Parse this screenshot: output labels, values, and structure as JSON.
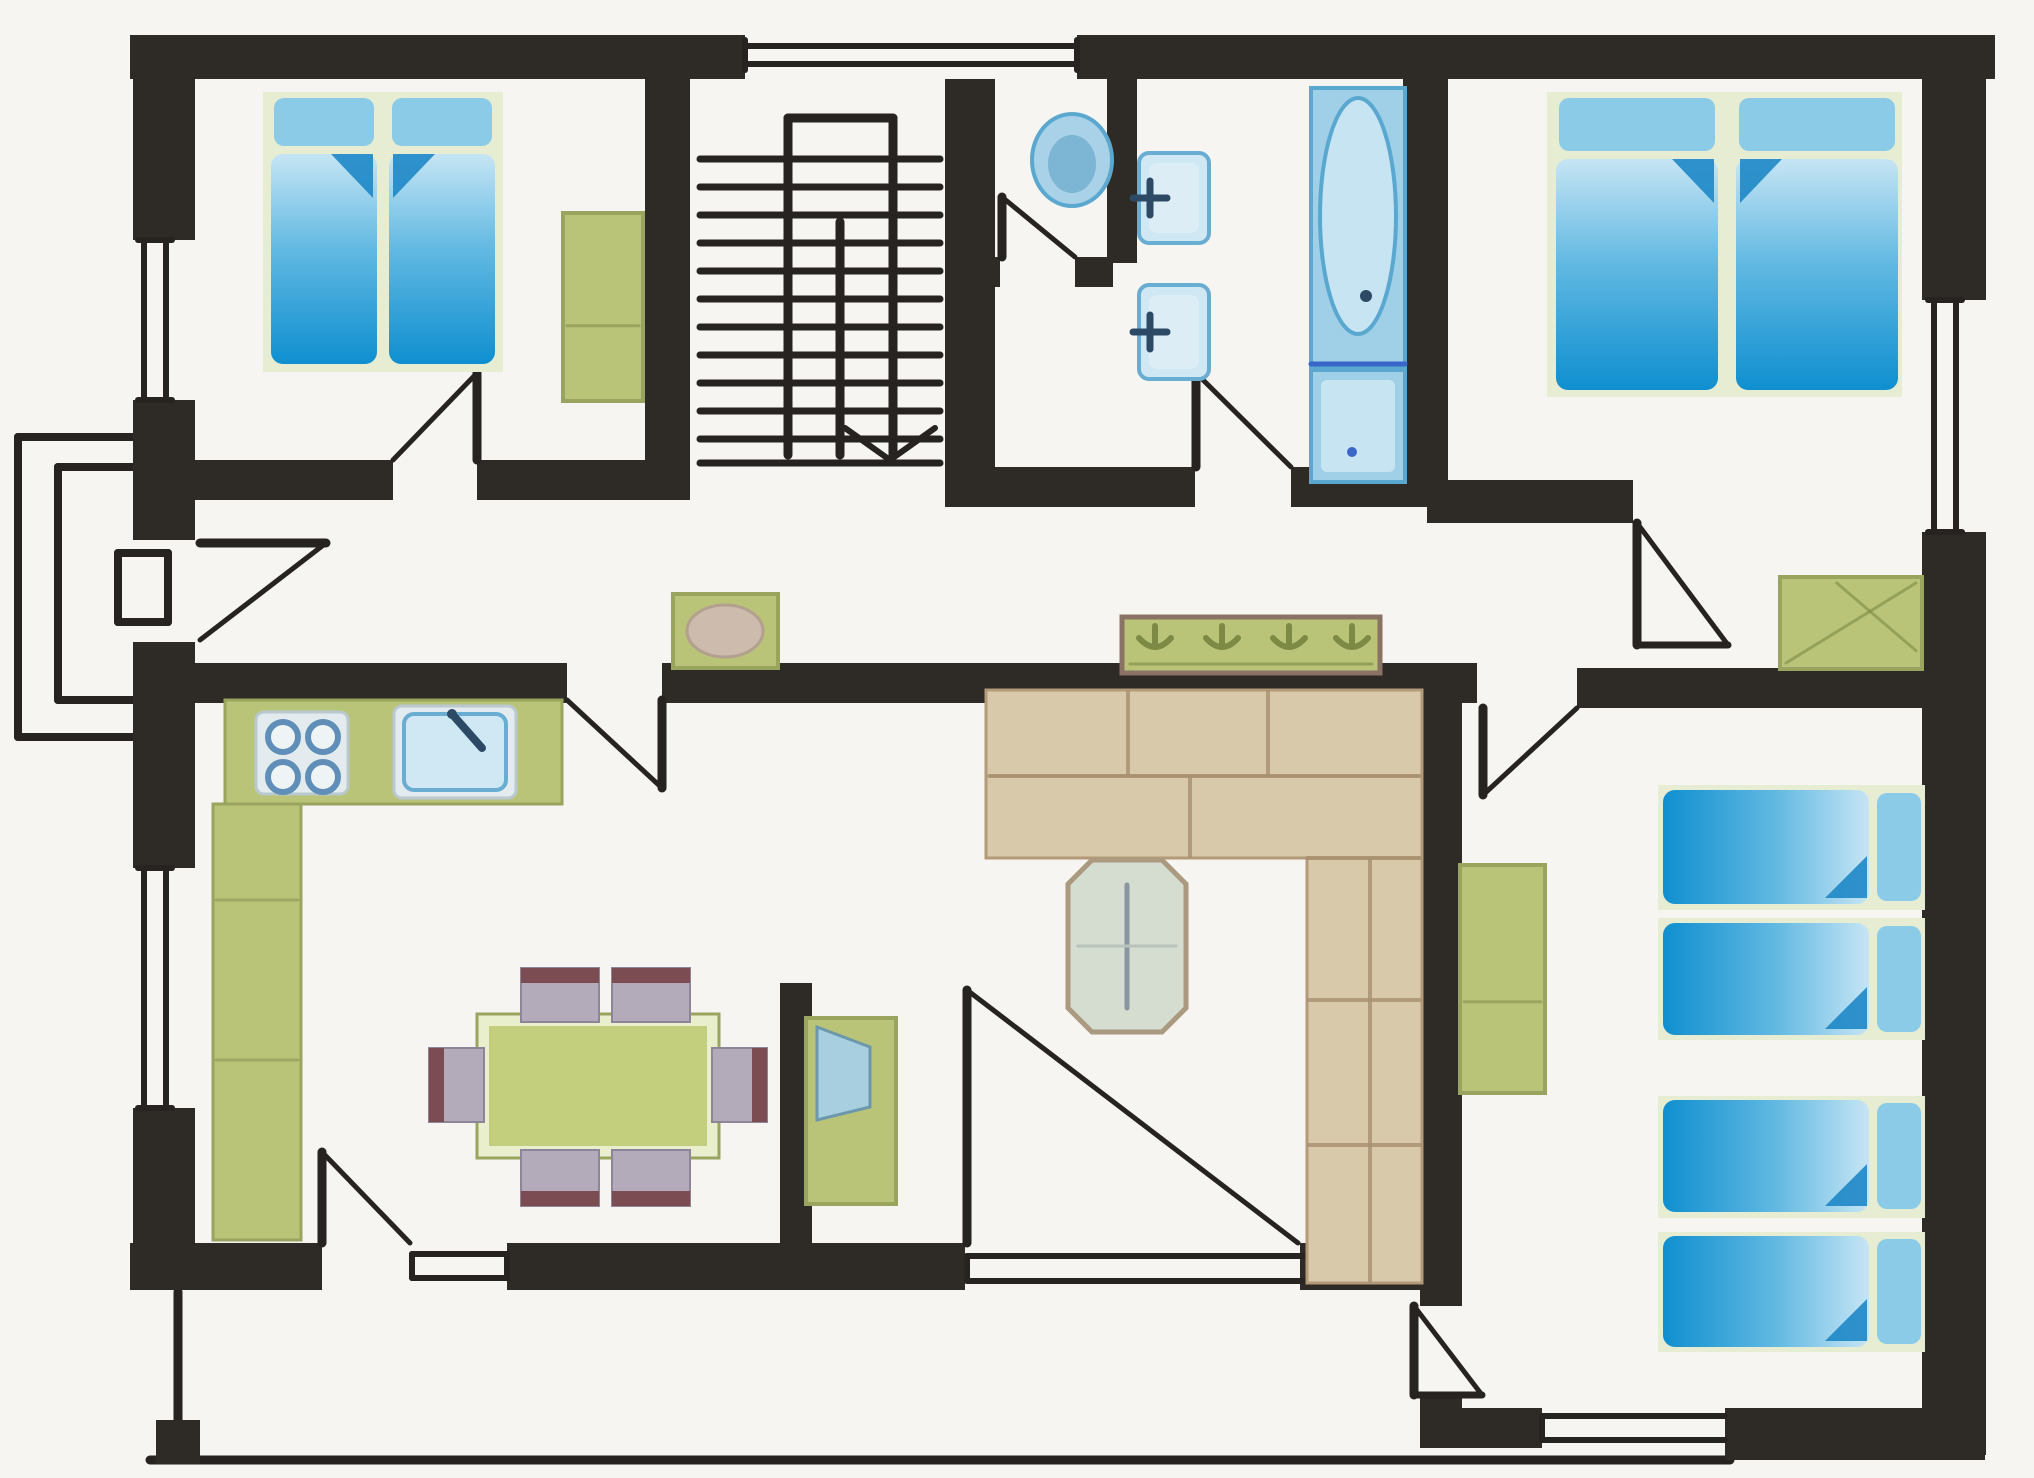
{
  "canvas": {
    "width": 2034,
    "height": 1478
  },
  "palette": {
    "paper": "#f7f5f2",
    "wall": "#2e2a26",
    "line": "#262320",
    "bed_deep": "#0f8fd0",
    "bed_mid": "#62b9e2",
    "bed_light": "#c6e5f4",
    "pillow": "#8ccbe8",
    "mat": "#e7edd2",
    "fold": "#1583c4",
    "green": "#b9c478",
    "green_dark": "#99a45e",
    "green_deep": "#7d8a45",
    "plate": "#e3ebee",
    "burner": "#5f8fb8",
    "basin_fill": "#cfe8f3",
    "basin_edge": "#69aed2",
    "fixture": "#9fd0e8",
    "fixture_deep": "#5aa8cf",
    "fixture_pale": "#c6e4f2",
    "ink_blue": "#2c4a66",
    "tub_line": "#3b66c9",
    "sofa": "#d9c9ab",
    "sofa_edge": "#b49a78",
    "sofa_seam": "#a8906f",
    "seat": "#b3aaba",
    "chair_back": "#7b4d52",
    "table_rim": "#e9eecd",
    "table_top": "#c3cf7d",
    "oct_fill": "#d4ddd0",
    "oct_edge": "#ab9980",
    "oct_line": "#8796a0",
    "rack_edge": "#8a7265",
    "oval_tan": "#cdbcad",
    "screen": "#a8cfe0",
    "screen_edge": "#6d98ac"
  },
  "rooms": [
    {
      "name": "room-bedroom-1",
      "r": [
        195,
        79,
        450,
        381
      ]
    },
    {
      "name": "room-stair-hall",
      "r": [
        690,
        79,
        255,
        426
      ]
    },
    {
      "name": "room-wc",
      "r": [
        995,
        79,
        112,
        178
      ]
    },
    {
      "name": "room-bathroom",
      "r": [
        1137,
        79,
        266,
        388
      ]
    },
    {
      "name": "room-bedroom-2",
      "r": [
        1448,
        79,
        474,
        401
      ]
    },
    {
      "name": "room-hallway",
      "r": [
        195,
        500,
        1727,
        163
      ]
    },
    {
      "name": "room-kitchen-dining",
      "r": [
        195,
        703,
        585,
        540
      ]
    },
    {
      "name": "room-living-room",
      "r": [
        812,
        703,
        608,
        540
      ]
    },
    {
      "name": "room-bedroom-3",
      "r": [
        1462,
        708,
        460,
        700
      ]
    },
    {
      "name": "room-terrace",
      "r": [
        195,
        1290,
        1225,
        168
      ]
    },
    {
      "name": "room-porch",
      "r": [
        18,
        437,
        159,
        300
      ]
    }
  ],
  "walls": [
    [
      130,
      35,
      615,
      44
    ],
    [
      1077,
      35,
      918,
      44
    ],
    [
      133,
      35,
      62,
      205
    ],
    [
      133,
      400,
      62,
      140
    ],
    [
      133,
      642,
      62,
      226
    ],
    [
      133,
      1108,
      62,
      182
    ],
    [
      1922,
      35,
      64,
      265
    ],
    [
      1922,
      532,
      64,
      923
    ],
    [
      130,
      1243,
      192,
      47
    ],
    [
      507,
      1243,
      458,
      47
    ],
    [
      1298,
      1243,
      164,
      47
    ],
    [
      1420,
      1408,
      122,
      40
    ],
    [
      1725,
      1408,
      260,
      52
    ],
    [
      645,
      35,
      45,
      465
    ],
    [
      133,
      460,
      260,
      40
    ],
    [
      477,
      460,
      213,
      40
    ],
    [
      945,
      35,
      50,
      472
    ],
    [
      1107,
      35,
      30,
      228
    ],
    [
      960,
      257,
      40,
      30
    ],
    [
      1075,
      257,
      38,
      30
    ],
    [
      945,
      467,
      250,
      40
    ],
    [
      1291,
      467,
      136,
      40
    ],
    [
      1403,
      35,
      45,
      472
    ],
    [
      1427,
      480,
      206,
      43
    ],
    [
      133,
      663,
      434,
      40
    ],
    [
      662,
      663,
      815,
      40
    ],
    [
      1577,
      668,
      345,
      40
    ],
    [
      1420,
      700,
      42,
      606
    ],
    [
      1420,
      1395,
      42,
      50
    ],
    [
      780,
      983,
      32,
      262
    ],
    [
      156,
      1420,
      44,
      44
    ]
  ],
  "windows": [
    {
      "name": "window-stair-top",
      "rect": [
        745,
        35,
        332,
        44
      ],
      "lines": [
        [
          745,
          46,
          1077,
          46
        ],
        [
          745,
          64,
          1077,
          64
        ],
        [
          745,
          40,
          745,
          70
        ],
        [
          1077,
          40,
          1077,
          70
        ]
      ]
    },
    {
      "name": "window-bedroom1-left",
      "rect": [
        133,
        240,
        62,
        160
      ],
      "lines": [
        [
          144,
          240,
          144,
          400
        ],
        [
          166,
          240,
          166,
          400
        ],
        [
          138,
          240,
          172,
          240
        ],
        [
          138,
          400,
          172,
          400
        ]
      ]
    },
    {
      "name": "window-kitchen-left",
      "rect": [
        133,
        868,
        62,
        240
      ],
      "lines": [
        [
          144,
          868,
          144,
          1108
        ],
        [
          166,
          868,
          166,
          1108
        ],
        [
          138,
          868,
          172,
          868
        ],
        [
          138,
          1108,
          172,
          1108
        ]
      ]
    },
    {
      "name": "window-bedroom2-right",
      "rect": [
        1922,
        300,
        64,
        232
      ],
      "lines": [
        [
          1934,
          300,
          1934,
          532
        ],
        [
          1956,
          300,
          1956,
          532
        ],
        [
          1928,
          300,
          1962,
          300
        ],
        [
          1928,
          532,
          1962,
          532
        ]
      ]
    },
    {
      "name": "window-kitchen-bottom",
      "rect": [
        412,
        1243,
        95,
        47
      ],
      "lines": [
        [
          412,
          1254,
          507,
          1254
        ],
        [
          412,
          1278,
          507,
          1278
        ],
        [
          412,
          1254,
          412,
          1278
        ],
        [
          507,
          1254,
          507,
          1278
        ]
      ]
    },
    {
      "name": "window-patio-bottom",
      "rect": [
        965,
        1243,
        335,
        47
      ],
      "lines": [
        [
          967,
          1256,
          1320,
          1256
        ],
        [
          967,
          1281,
          1320,
          1281
        ],
        [
          967,
          1256,
          967,
          1281
        ]
      ]
    },
    {
      "name": "window-bedroom3-bottom",
      "rect": [
        1542,
        1408,
        183,
        40
      ],
      "lines": [
        [
          1542,
          1416,
          1725,
          1416
        ],
        [
          1542,
          1440,
          1725,
          1440
        ],
        [
          1542,
          1416,
          1542,
          1440
        ]
      ]
    }
  ],
  "doors": [
    {
      "name": "door-bedroom-1",
      "leaf": [
        477,
        373,
        477,
        460
      ],
      "swing": [
        477,
        373,
        393,
        460
      ]
    },
    {
      "name": "door-wc",
      "leaf": [
        1002,
        197,
        1002,
        257
      ],
      "swing": [
        1002,
        197,
        1075,
        257
      ]
    },
    {
      "name": "door-bathroom",
      "leaf": [
        1196,
        373,
        1196,
        467
      ],
      "swing": [
        1196,
        373,
        1291,
        467
      ]
    },
    {
      "name": "door-bedroom-2",
      "leaf": [
        1637,
        523,
        1637,
        645
      ],
      "swing": [
        1637,
        523,
        1728,
        645
      ],
      "base": [
        1637,
        645,
        1728,
        645
      ]
    },
    {
      "name": "door-entrance",
      "leaf": [
        200,
        543,
        326,
        543
      ],
      "swing": [
        326,
        543,
        200,
        640
      ]
    },
    {
      "name": "door-kitchen",
      "leaf": [
        662,
        700,
        662,
        788
      ],
      "swing": [
        567,
        700,
        662,
        788
      ]
    },
    {
      "name": "door-bedroom-3-hall",
      "leaf": [
        1483,
        708,
        1483,
        795
      ],
      "swing": [
        1577,
        708,
        1483,
        795
      ]
    },
    {
      "name": "door-patio",
      "leaf": [
        967,
        990,
        967,
        1243
      ],
      "swing": [
        967,
        990,
        1298,
        1243
      ]
    },
    {
      "name": "door-kitchen-back",
      "leaf": [
        322,
        1152,
        322,
        1243
      ],
      "swing": [
        322,
        1152,
        410,
        1243
      ]
    },
    {
      "name": "door-bedroom-3-terrace",
      "leaf": [
        1414,
        1306,
        1414,
        1395
      ],
      "swing": [
        1414,
        1306,
        1482,
        1395
      ],
      "base": [
        1414,
        1395,
        1482,
        1395
      ]
    }
  ],
  "stairs": {
    "x1": 700,
    "x2": 940,
    "tread_ys": [
      159,
      187,
      215,
      243,
      271,
      299,
      327,
      355,
      383,
      411,
      439,
      463
    ],
    "rails": [
      [
        788,
        118,
        893,
        118
      ],
      [
        788,
        118,
        788,
        455
      ],
      [
        893,
        118,
        893,
        455
      ],
      [
        840,
        222,
        840,
        455
      ]
    ],
    "arrow": [
      [
        845,
        428,
        890,
        460
      ],
      [
        935,
        428,
        890,
        460
      ]
    ]
  },
  "porch": {
    "lines": [
      [
        18,
        437,
        177,
        437
      ],
      [
        18,
        437,
        18,
        737
      ],
      [
        18,
        737,
        177,
        737
      ],
      [
        58,
        467,
        177,
        467
      ],
      [
        58,
        467,
        58,
        700
      ],
      [
        58,
        700,
        177,
        700
      ],
      [
        118,
        553,
        168,
        553
      ],
      [
        168,
        553,
        168,
        622
      ],
      [
        118,
        622,
        168,
        622
      ],
      [
        118,
        553,
        118,
        622
      ]
    ]
  },
  "terrace": {
    "lines": [
      [
        150,
        1460,
        1730,
        1460
      ],
      [
        178,
        1292,
        178,
        1456
      ]
    ]
  },
  "furniture": {
    "mats": [
      [
        263,
        92,
        240,
        280
      ],
      [
        1547,
        92,
        355,
        305
      ],
      [
        1658,
        785,
        267,
        125
      ],
      [
        1658,
        918,
        267,
        122
      ],
      [
        1658,
        1096,
        267,
        122
      ],
      [
        1658,
        1232,
        267,
        120
      ]
    ],
    "mattresses": [
      {
        "name": "bed-bedroom1-left",
        "r": [
          271,
          98,
          106,
          266
        ],
        "dir": "up",
        "fold": "r"
      },
      {
        "name": "bed-bedroom1-right",
        "r": [
          389,
          98,
          106,
          266
        ],
        "dir": "up",
        "fold": "l"
      },
      {
        "name": "bed-bedroom2-left",
        "r": [
          1556,
          98,
          162,
          292
        ],
        "dir": "up",
        "fold": "r"
      },
      {
        "name": "bed-bedroom2-right",
        "r": [
          1736,
          98,
          162,
          292
        ],
        "dir": "up",
        "fold": "l"
      },
      {
        "name": "bed-bedroom3-1",
        "r": [
          1663,
          790,
          258,
          114
        ],
        "dir": "right"
      },
      {
        "name": "bed-bedroom3-2",
        "r": [
          1663,
          923,
          258,
          112
        ],
        "dir": "right"
      },
      {
        "name": "bed-bedroom3-3",
        "r": [
          1663,
          1100,
          258,
          112
        ],
        "dir": "right"
      },
      {
        "name": "bed-bedroom3-4",
        "r": [
          1663,
          1236,
          258,
          111
        ],
        "dir": "right"
      }
    ],
    "wardrobes": [
      {
        "name": "wardrobe-bedroom1",
        "r": [
          563,
          213,
          80,
          188
        ]
      },
      {
        "name": "wardrobe-hall",
        "r": [
          1780,
          577,
          142,
          92
        ],
        "diag": true
      },
      {
        "name": "wardrobe-bedroom3",
        "r": [
          1460,
          865,
          85,
          228
        ]
      }
    ],
    "kitchen": {
      "counter_top": [
        225,
        700,
        337,
        104
      ],
      "counter_left": [
        213,
        804,
        88,
        436
      ],
      "counter_seams": [
        [
          216,
          900,
          298,
          900
        ],
        [
          216,
          1060,
          298,
          1060
        ]
      ],
      "stove_plate": [
        256,
        712,
        92,
        82
      ],
      "burners": [
        [
          283,
          737
        ],
        [
          323,
          737
        ],
        [
          283,
          777
        ],
        [
          323,
          777
        ]
      ],
      "burner_r": 15,
      "sink_plate": [
        394,
        706,
        122,
        92
      ],
      "sink_basin": [
        404,
        714,
        102,
        76
      ],
      "faucet": [
        452,
        714,
        482,
        748
      ]
    },
    "dining": {
      "rim": [
        477,
        1014,
        242,
        144
      ],
      "top": [
        489,
        1026,
        218,
        120
      ],
      "chairs": [
        {
          "r": [
            521,
            968,
            78,
            54
          ],
          "back": "top"
        },
        {
          "r": [
            612,
            968,
            78,
            54
          ],
          "back": "top"
        },
        {
          "r": [
            521,
            1150,
            78,
            56
          ],
          "back": "bottom"
        },
        {
          "r": [
            612,
            1150,
            78,
            56
          ],
          "back": "bottom"
        },
        {
          "r": [
            429,
            1048,
            55,
            74
          ],
          "back": "left"
        },
        {
          "r": [
            712,
            1048,
            55,
            74
          ],
          "back": "right"
        }
      ]
    },
    "tv": {
      "cabinet": [
        806,
        1018,
        90,
        186
      ],
      "screen": [
        [
          817,
          1027
        ],
        [
          870,
          1047
        ],
        [
          870,
          1107
        ],
        [
          817,
          1120
        ]
      ]
    },
    "hall_table": {
      "r": [
        673,
        594,
        105,
        74
      ],
      "oval": [
        725,
        631,
        38,
        26
      ]
    },
    "coat_rack": {
      "r": [
        1122,
        617,
        258,
        56
      ],
      "hooks": [
        1155,
        1222,
        1289,
        1352
      ],
      "hook_y": 640,
      "shelf_line": [
        1130,
        664,
        1372,
        664
      ]
    },
    "sofa": {
      "rects": [
        [
          986,
          690,
          436,
          86
        ],
        [
          986,
          776,
          436,
          82
        ],
        [
          1307,
          858,
          115,
          425
        ]
      ],
      "seams": [
        [
          1128,
          692,
          1128,
          774
        ],
        [
          1268,
          692,
          1268,
          774
        ],
        [
          990,
          776,
          1420,
          776
        ],
        [
          1190,
          778,
          1190,
          856
        ],
        [
          1307,
          858,
          1420,
          858
        ],
        [
          1309,
          1000,
          1420,
          1000
        ],
        [
          1309,
          1145,
          1420,
          1145
        ],
        [
          1370,
          860,
          1370,
          1281
        ]
      ]
    },
    "coffee_table": {
      "pts": [
        [
          1092,
          860
        ],
        [
          1162,
          860
        ],
        [
          1186,
          884
        ],
        [
          1186,
          1008
        ],
        [
          1162,
          1032
        ],
        [
          1092,
          1032
        ],
        [
          1068,
          1008
        ],
        [
          1068,
          884
        ]
      ],
      "vline": [
        1127,
        885,
        1127,
        1008
      ],
      "hline": [
        1078,
        946,
        1176,
        946
      ]
    },
    "bathroom": {
      "toilet": {
        "cx": 1072,
        "cy": 160,
        "rx": 40,
        "ry": 46
      },
      "sinks": [
        [
          1139,
          153,
          70,
          90
        ],
        [
          1139,
          285,
          70,
          94
        ]
      ],
      "taps": [
        [
          1150,
          198
        ],
        [
          1150,
          332
        ]
      ],
      "tub": {
        "r": [
          1311,
          88,
          94,
          278
        ],
        "oval": [
          1358,
          216,
          38,
          118
        ],
        "drain": [
          1366,
          296
        ],
        "divider": [
          1311,
          364,
          1405,
          364
        ]
      },
      "shower": [
        1311,
        370,
        94,
        112
      ],
      "shower_dot": [
        1352,
        452
      ]
    }
  }
}
